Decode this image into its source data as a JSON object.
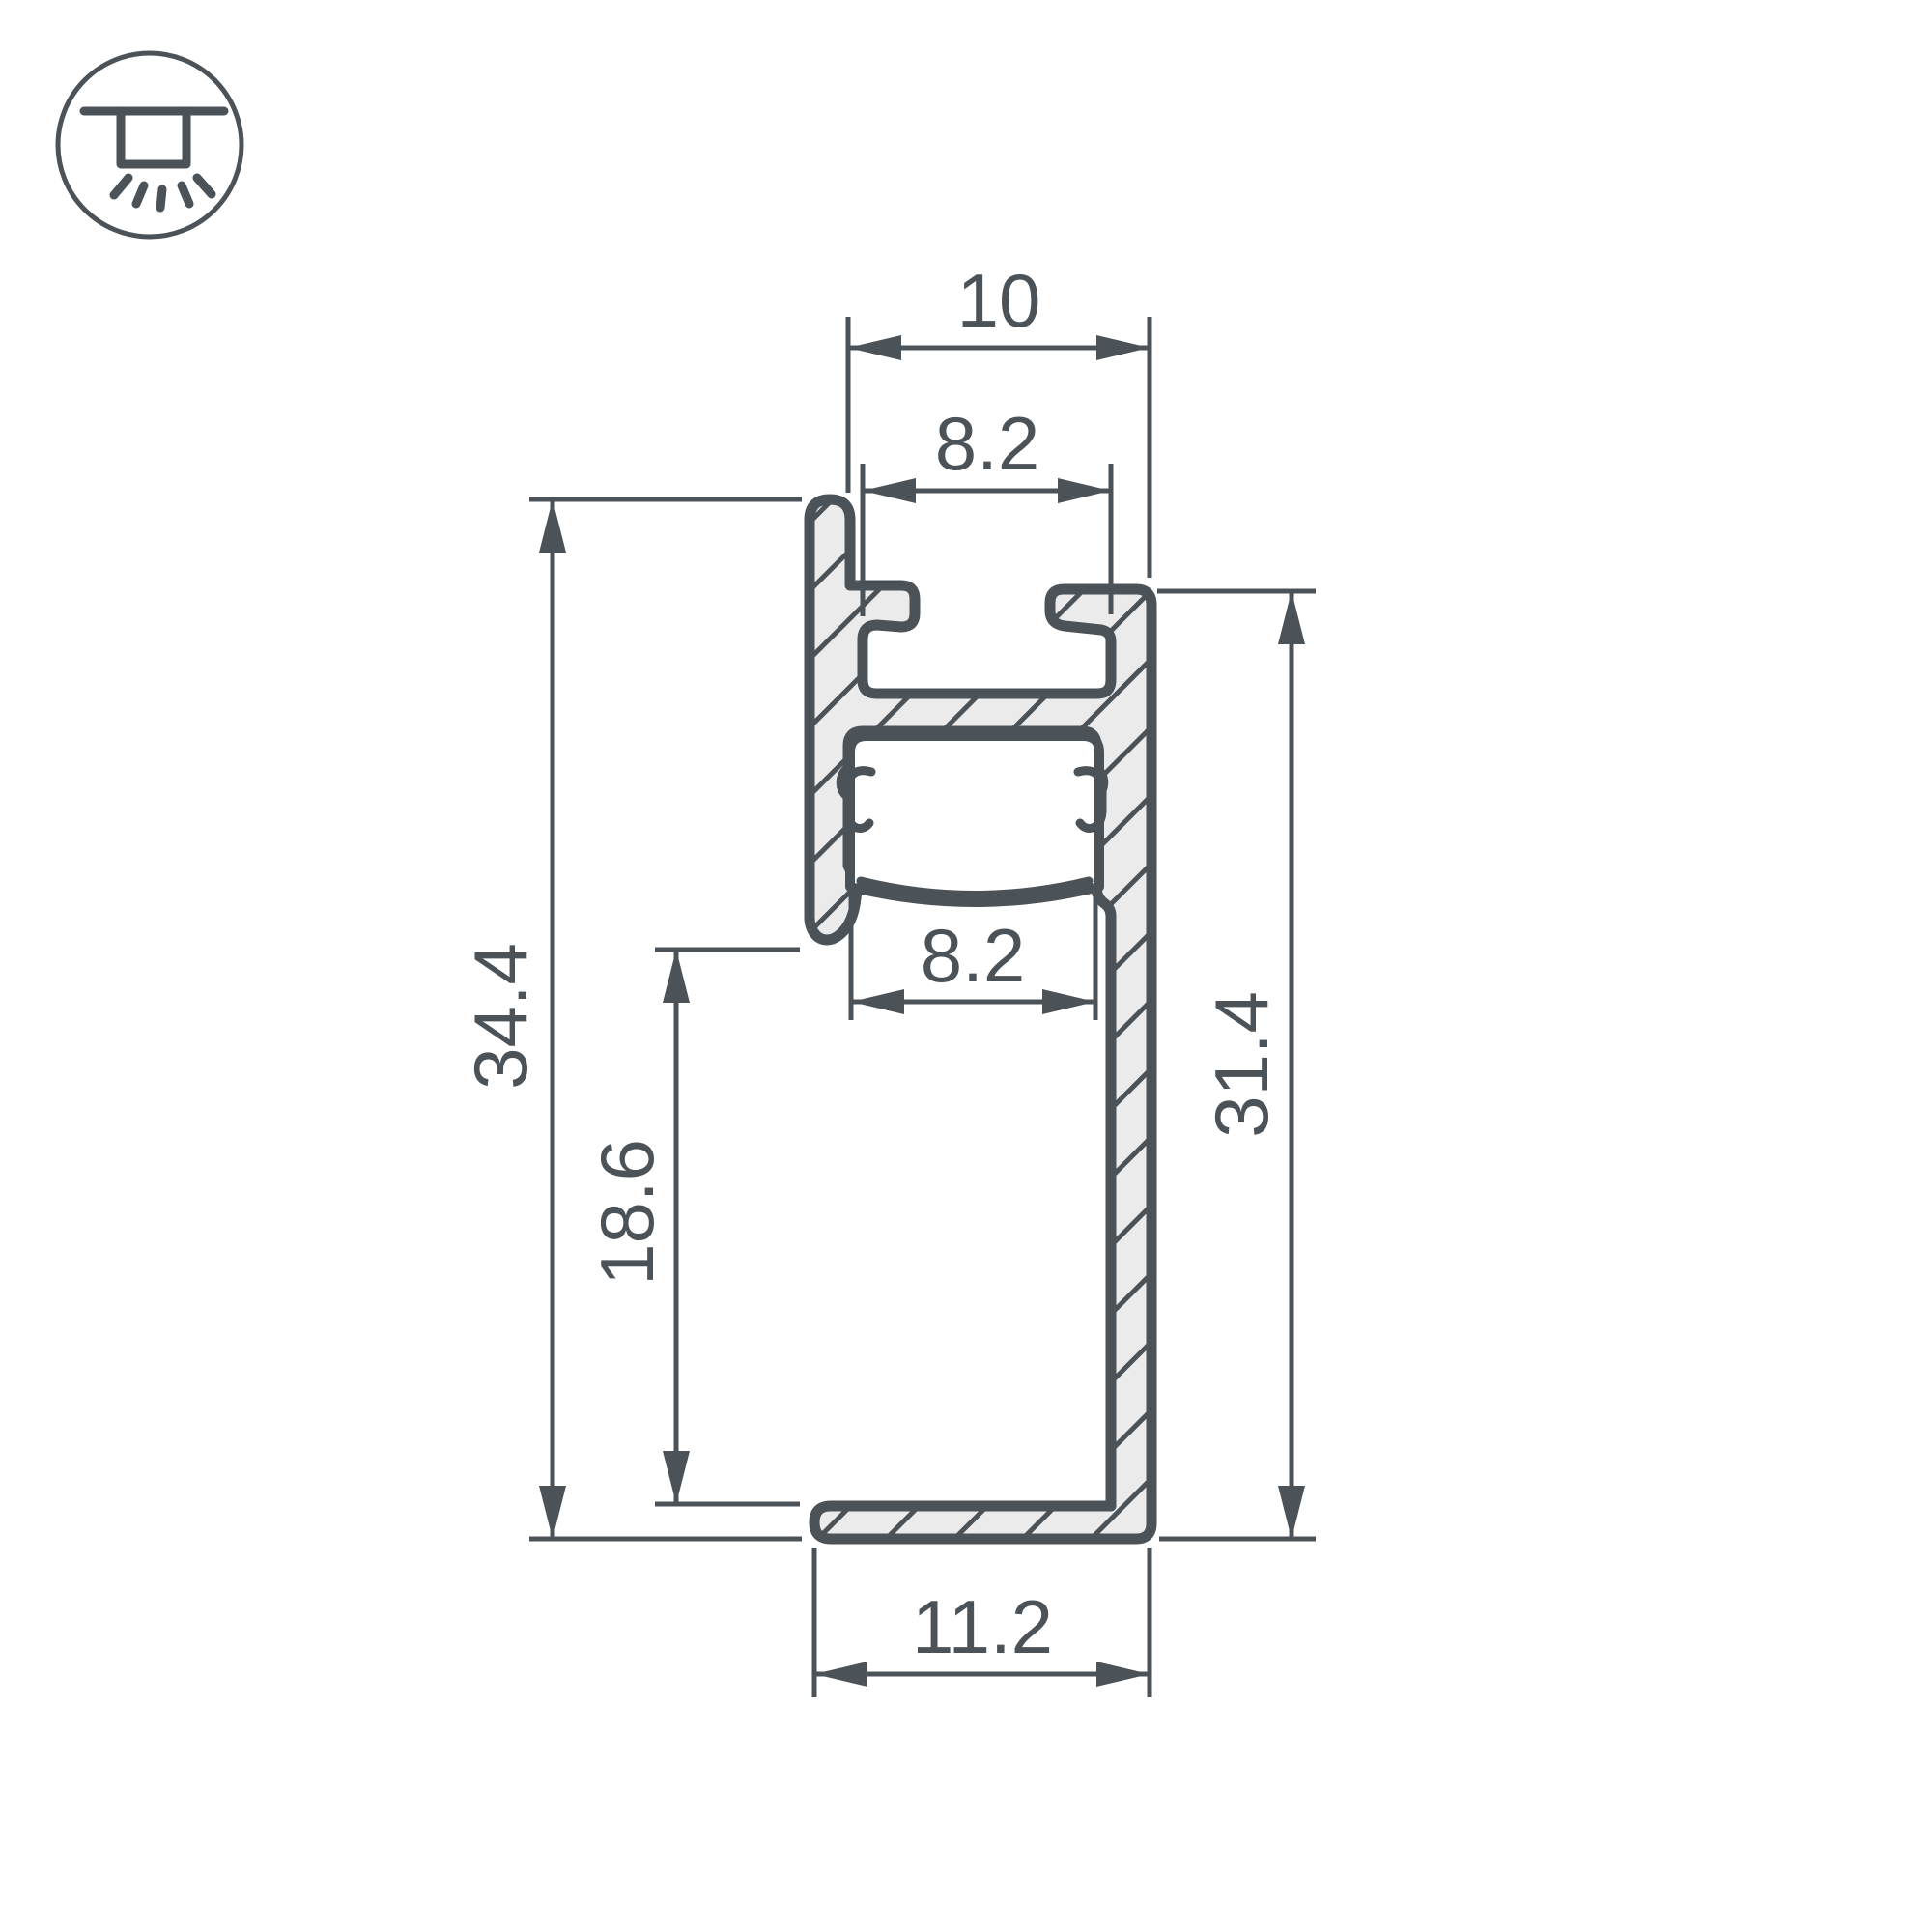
{
  "colors": {
    "line": "#4b5258",
    "metal_fill": "#ebebeb",
    "background": "#ffffff"
  },
  "icon": {
    "name": "ceiling-recessed-light"
  },
  "dimensions": {
    "top_outer_width": "10",
    "top_slot_width": "8.2",
    "diffuser_channel_width": "8.2",
    "overall_height_left": "34.4",
    "lower_left_height": "18.6",
    "right_side_height": "31.4",
    "bottom_flange_width": "11.2"
  }
}
